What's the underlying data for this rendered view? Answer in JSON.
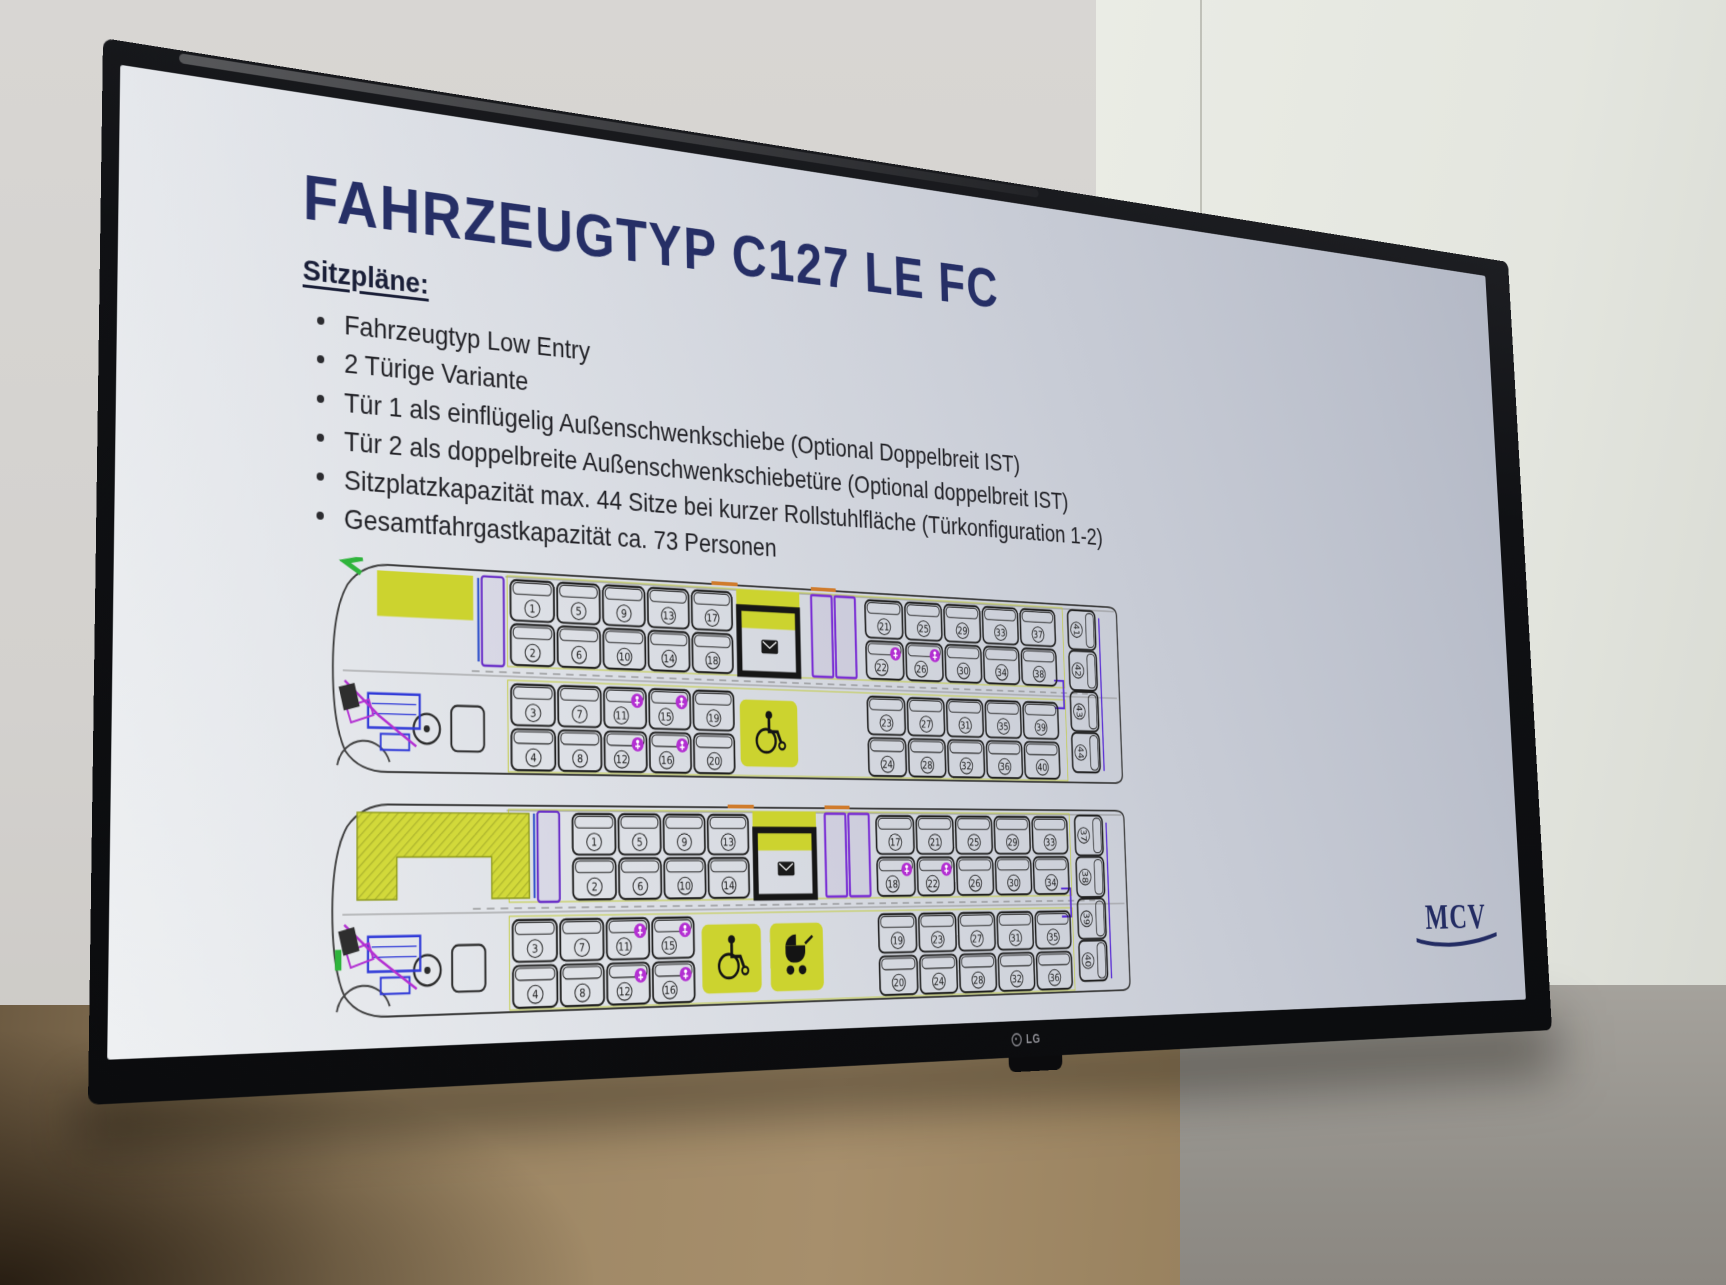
{
  "scene": {
    "tv_brand": "LG",
    "colors": {
      "wall_left": "#d6d4d1",
      "wall_panel": "#e9ebe4",
      "wall_bottom_left": "#a18a67",
      "wall_bottom_right": "#918e88",
      "bezel": "#101114",
      "screen_top": "#b4b9c6",
      "screen_bottom": "#eef0f2"
    }
  },
  "slide": {
    "title": "FAHRZEUGTYP C127 LE FC",
    "subtitle": "Sitzpläne:",
    "accent": "#262f66",
    "bullets": [
      "Fahrzeugtyp Low Entry",
      "2 Türige Variante",
      "Tür 1 als einflügelig Außenschwenkschiebe (Optional Doppelbreit IST)",
      "Tür 2 als doppelbreite Außenschwenkschiebetüre (Optional doppelbreit IST)",
      "Sitzplatzkapazität max. 44 Sitze bei kurzer Rollstuhlfläche (Türkonfiguration 1-2)",
      "Gesamtfahrgastkapazität ca. 73 Personen"
    ],
    "logo": "MCV",
    "diagram_colors": {
      "outline": "#3d3d3d",
      "seat": "#212121",
      "yellow": "#ccd32f",
      "door_purple": "#7a2fd4",
      "magenta": "#b32fd2",
      "blue": "#2f39d8",
      "green": "#2fb43c",
      "orange": "#d07b2b",
      "accent_line": "#c2cb3a"
    }
  },
  "seatmaps": [
    {
      "id": "seatplan-44-seats",
      "icon_seats": [
        11,
        12,
        15,
        16,
        22,
        26
      ],
      "top": [
        {
          "t": "mirror"
        },
        {
          "t": "skip",
          "w": 62
        },
        {
          "t": "yrect",
          "adv": 118
        },
        {
          "t": "door1",
          "adv": 36
        },
        {
          "t": "pair",
          "n": [
            1,
            2
          ]
        },
        {
          "t": "pair",
          "n": [
            5,
            6
          ]
        },
        {
          "t": "pair",
          "n": [
            9,
            10
          ]
        },
        {
          "t": "pair",
          "n": [
            13,
            14
          ]
        },
        {
          "t": "pair",
          "n": [
            17,
            18
          ]
        },
        {
          "t": "bay",
          "adv": 100
        },
        {
          "t": "door",
          "adv": 76
        },
        {
          "t": "pair",
          "n": [
            21,
            22
          ]
        },
        {
          "t": "pair",
          "n": [
            25,
            26
          ]
        },
        {
          "t": "pair",
          "n": [
            29,
            30
          ]
        },
        {
          "t": "pair",
          "n": [
            33,
            34
          ]
        },
        {
          "t": "pair",
          "n": [
            37,
            38
          ]
        }
      ],
      "bottom": [
        {
          "t": "cab",
          "adv": 216
        },
        {
          "t": "pair",
          "n": [
            3,
            4
          ]
        },
        {
          "t": "pair",
          "n": [
            7,
            8
          ]
        },
        {
          "t": "pair",
          "n": [
            11,
            12
          ]
        },
        {
          "t": "pair",
          "n": [
            15,
            16
          ]
        },
        {
          "t": "pair",
          "n": [
            19,
            20
          ]
        },
        {
          "t": "skip",
          "w": 4
        },
        {
          "t": "wc",
          "adv": 88
        },
        {
          "t": "skip",
          "w": 84
        },
        {
          "t": "pair",
          "n": [
            23,
            24
          ]
        },
        {
          "t": "pair",
          "n": [
            27,
            28
          ]
        },
        {
          "t": "pair",
          "n": [
            31,
            32
          ]
        },
        {
          "t": "pair",
          "n": [
            35,
            36
          ]
        },
        {
          "t": "pair",
          "n": [
            39,
            40
          ]
        }
      ],
      "rear": [
        41,
        42,
        43,
        44
      ]
    },
    {
      "id": "seatplan-40-seats",
      "icon_seats": [
        11,
        12,
        15,
        16,
        18,
        22
      ],
      "top": [
        {
          "t": "green2"
        },
        {
          "t": "skip",
          "w": 40
        },
        {
          "t": "yhatch",
          "adv": 204
        },
        {
          "t": "door1",
          "adv": 44
        },
        {
          "t": "pair",
          "n": [
            1,
            2
          ]
        },
        {
          "t": "pair",
          "n": [
            5,
            6
          ]
        },
        {
          "t": "pair",
          "n": [
            9,
            10
          ]
        },
        {
          "t": "pair",
          "n": [
            13,
            14
          ]
        },
        {
          "t": "bay",
          "adv": 96
        },
        {
          "t": "door",
          "adv": 72
        },
        {
          "t": "pair",
          "n": [
            17,
            18
          ]
        },
        {
          "t": "pair",
          "n": [
            21,
            22
          ]
        },
        {
          "t": "pair",
          "n": [
            25,
            26
          ]
        },
        {
          "t": "pair",
          "n": [
            29,
            30
          ]
        },
        {
          "t": "pair",
          "n": [
            33,
            34
          ]
        }
      ],
      "bottom": [
        {
          "t": "cab",
          "adv": 216
        },
        {
          "t": "pair",
          "n": [
            3,
            4
          ]
        },
        {
          "t": "pair",
          "n": [
            7,
            8
          ]
        },
        {
          "t": "pair",
          "n": [
            11,
            12
          ]
        },
        {
          "t": "pair",
          "n": [
            15,
            16
          ]
        },
        {
          "t": "skip",
          "w": 6
        },
        {
          "t": "wc",
          "adv": 88
        },
        {
          "t": "pram",
          "adv": 82
        },
        {
          "t": "skip",
          "w": 64
        },
        {
          "t": "pair",
          "n": [
            19,
            20
          ]
        },
        {
          "t": "pair",
          "n": [
            23,
            24
          ]
        },
        {
          "t": "pair",
          "n": [
            27,
            28
          ]
        },
        {
          "t": "pair",
          "n": [
            31,
            32
          ]
        },
        {
          "t": "pair",
          "n": [
            35,
            36
          ]
        }
      ],
      "rear": [
        37,
        38,
        39,
        40
      ]
    }
  ]
}
